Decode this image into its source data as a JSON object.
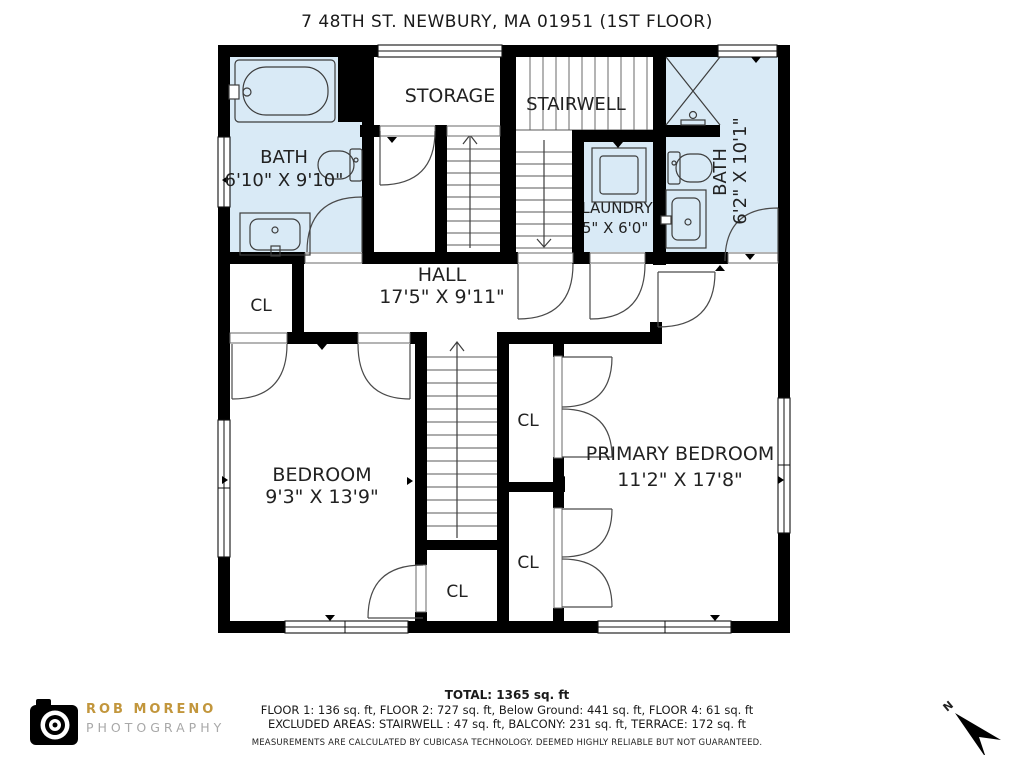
{
  "title": "7 48TH ST. NEWBURY, MA 01951 (1ST FLOOR)",
  "colors": {
    "room_highlight_blue": "#D9EAF6",
    "wall_black": "#000000",
    "logo_gold": "#C2963C",
    "logo_gray": "#A8A8A8"
  },
  "rooms": {
    "bath_left": {
      "name": "BATH",
      "dims": "6'10\" X 9'10\""
    },
    "storage": {
      "name": "STORAGE"
    },
    "stairwell": {
      "name": "STAIRWELL"
    },
    "laundry": {
      "name": "LAUNDRY",
      "dims": "'5\" X 6'0\""
    },
    "bath_right": {
      "name": "BATH",
      "dims": "6'2\" X 10'1\""
    },
    "hall": {
      "name": "HALL",
      "dims": "17'5\" X 9'11\""
    },
    "closet_hall": {
      "name": "CL"
    },
    "bedroom": {
      "name": "BEDROOM",
      "dims": "9'3\" X 13'9\""
    },
    "primary_bedroom": {
      "name": "PRIMARY BEDROOM",
      "dims": "11'2\" X 17'8\""
    },
    "closet_upper": {
      "name": "CL"
    },
    "closet_lower": {
      "name": "CL"
    },
    "closet_bedroom": {
      "name": "CL"
    }
  },
  "footer": {
    "total": "TOTAL: 1365 sq. ft",
    "floors": "FLOOR 1: 136 sq. ft, FLOOR 2: 727 sq. ft, Below Ground: 441 sq. ft, FLOOR 4: 61 sq. ft",
    "excluded": "EXCLUDED AREAS: STAIRWELL : 47 sq. ft, BALCONY: 231 sq. ft, TERRACE: 172 sq. ft",
    "disclaimer": "MEASUREMENTS ARE CALCULATED BY CUBICASA TECHNOLOGY. DEEMED HIGHLY RELIABLE BUT NOT GUARANTEED."
  },
  "logo": {
    "line1": "ROB MORENO",
    "line2": "PHOTOGRAPHY"
  },
  "compass": {
    "label": "N"
  }
}
